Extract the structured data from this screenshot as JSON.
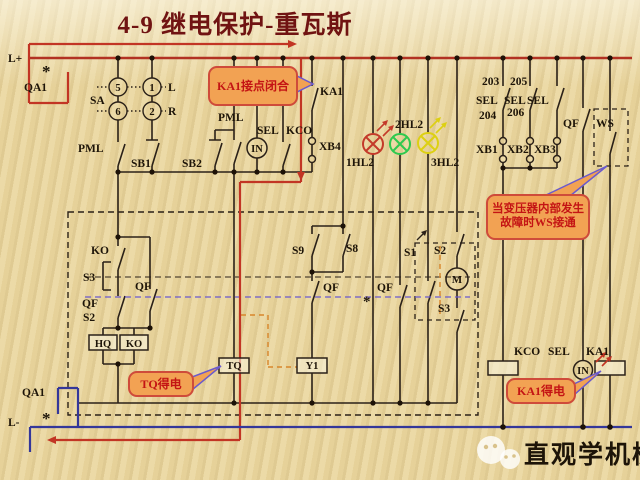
{
  "title": "4-9  继电保护-重瓦斯",
  "power": {
    "l_plus": "L+",
    "qa1_top": "QA1",
    "l_minus": "L-",
    "qa1_bottom": "QA1",
    "break_mark": "*"
  },
  "selector_sa": {
    "label": "SA",
    "t5": "5",
    "t1": "1",
    "t6": "6",
    "t2": "2",
    "left": "L",
    "right": "R"
  },
  "control_row": {
    "pml_left": "PML",
    "sb1": "SB1",
    "sb2": "SB2",
    "pml_mid": "PML",
    "sel": "SEL",
    "kco": "KCO",
    "in_relay": "IN",
    "xb4": "XB4",
    "ka1_contact": "KA1"
  },
  "lamps": {
    "red": "1HL2",
    "green": "2HL2",
    "yellow": "3HL2"
  },
  "right_bank": {
    "n203": "203",
    "n205": "205",
    "sel_a": "SEL",
    "n204": "204",
    "sel_b": "SEL",
    "n206": "206",
    "sel_c": "SEL",
    "xb1": "XB1",
    "xb2": "XB2",
    "xb3": "XB3",
    "qf": "QF",
    "ws": "WS"
  },
  "interlock_box": {
    "ko": "KO",
    "s3": "S3",
    "qf_a": "QF",
    "s2": "S2",
    "qf_b": "QF",
    "hq_coil": "HQ",
    "ko_coil": "KO",
    "s9": "S9",
    "s8": "S8",
    "qf_c": "QF",
    "qf_d": "QF",
    "s1": "S1",
    "s2_motor": "S2",
    "motor": "M",
    "s3_motor": "S3",
    "tq_coil": "TQ",
    "y1_coil": "Y1",
    "qf_mark": "*"
  },
  "output_row": {
    "kco": "KCO",
    "sel": "SEL",
    "in_relay": "IN",
    "ka1": "KA1"
  },
  "callouts": {
    "ka1_close": "KA1接点闭合",
    "ws_note": "当变压器内部发生故障时WS接通",
    "tq_note": "TQ得电",
    "ka1_note": "KA1得电"
  },
  "watermark": {
    "text": "直观学机械"
  },
  "colors": {
    "positive_bus": "#b23222",
    "negative_bus": "#34379a",
    "energized_path": "#c23524",
    "lamp_red": "#c43a2a",
    "lamp_green": "#2fc94e",
    "lamp_yellow": "#ddd012",
    "callout_fill": "#f2a253",
    "callout_text": "#c41414",
    "callout_border": "#cf4b3a",
    "line": "#2b2118",
    "link_dash": "#6a5acd",
    "mech_dash": "#d8862a",
    "title": "#701312"
  }
}
